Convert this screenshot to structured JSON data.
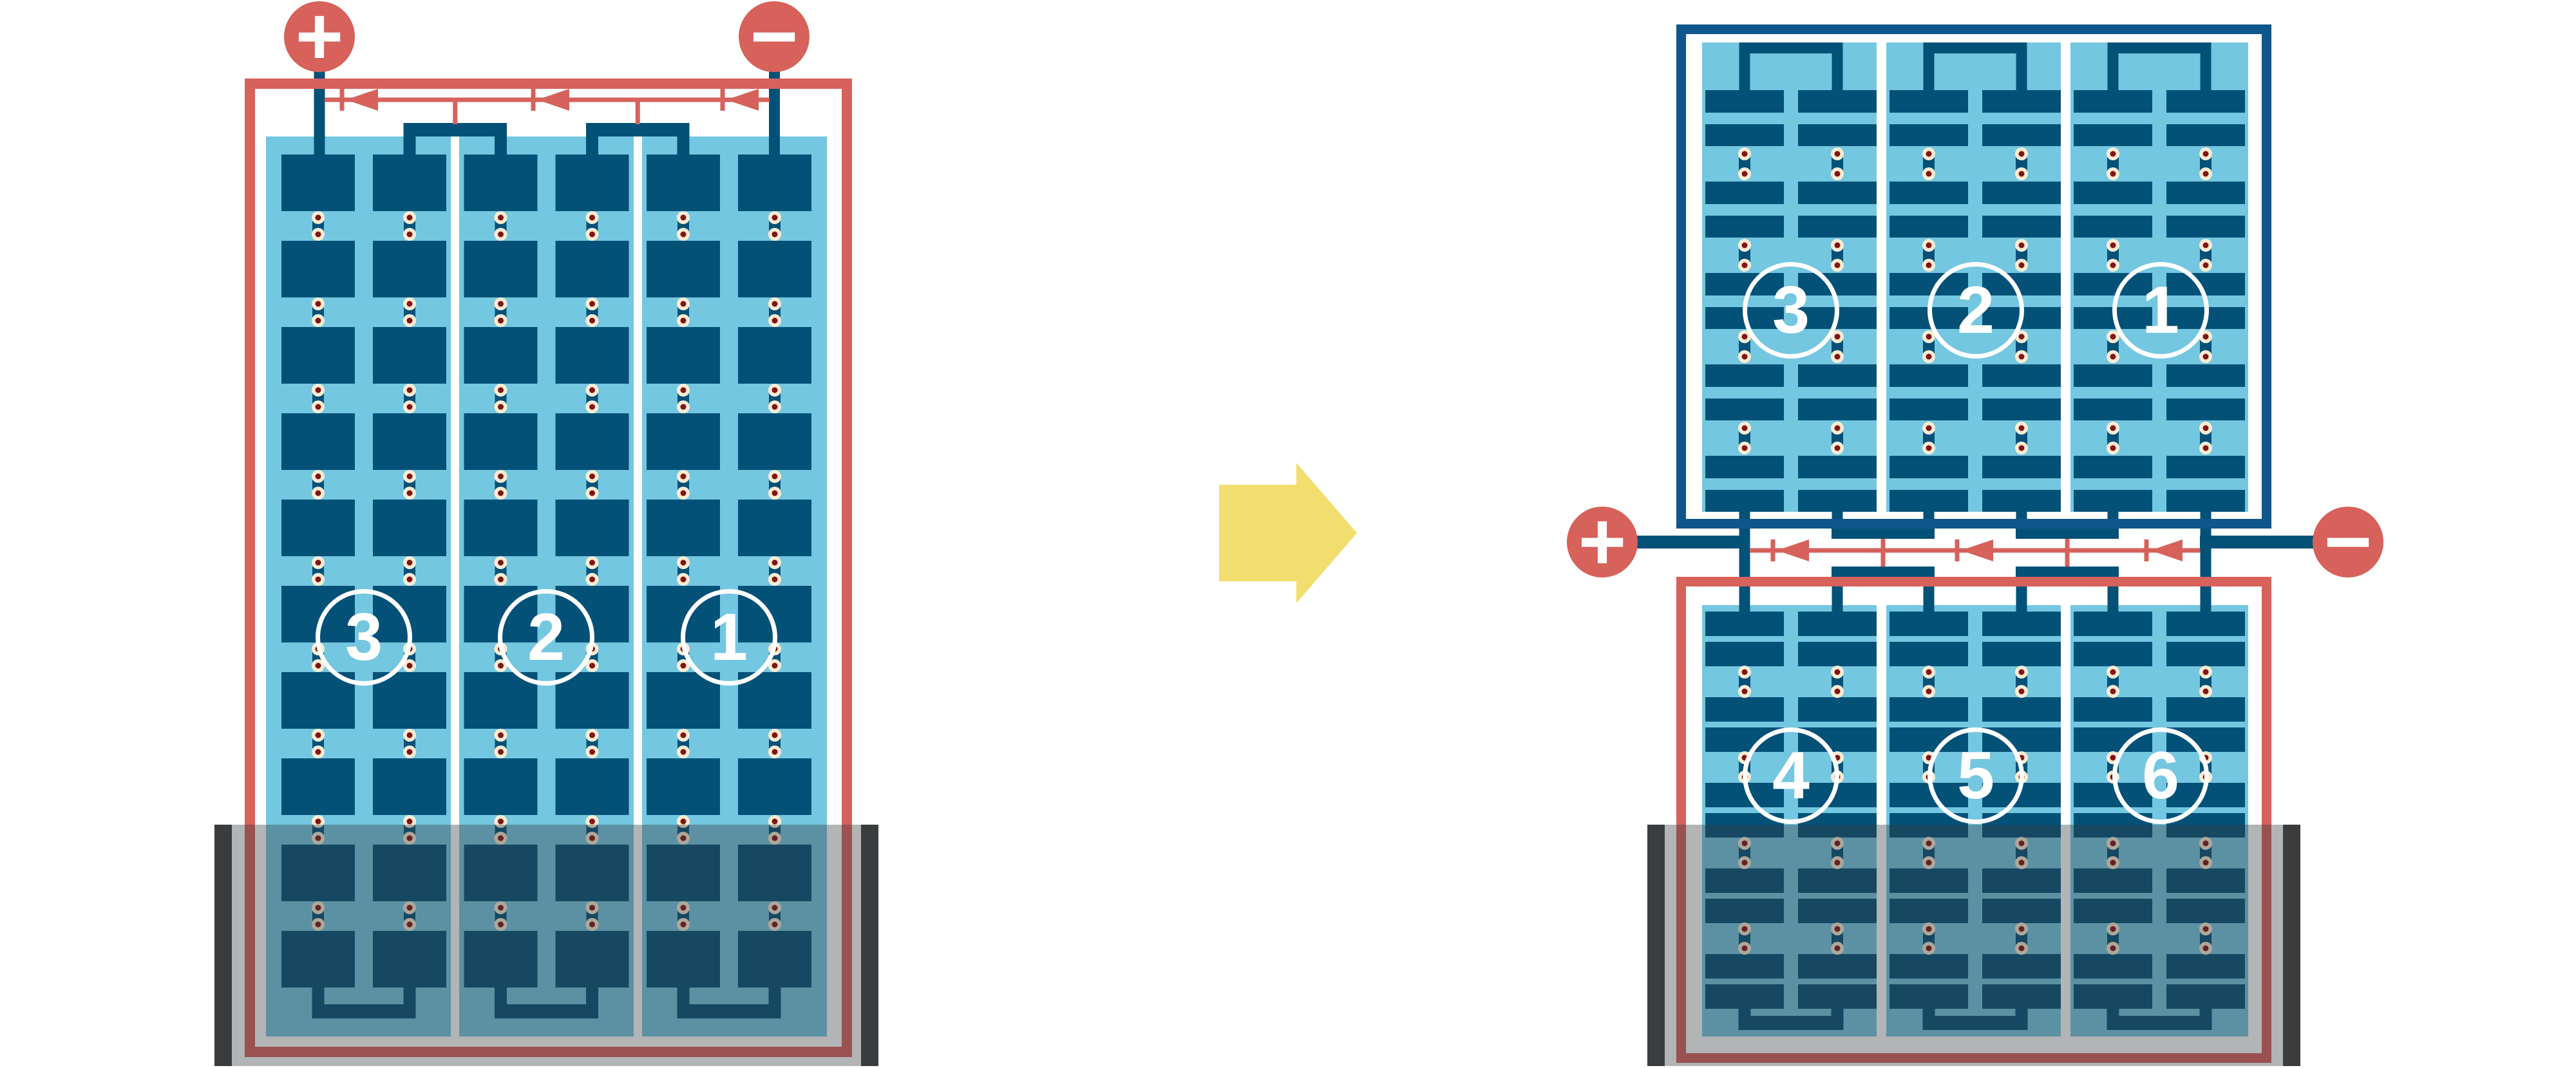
{
  "colors": {
    "red": "#D7615B",
    "cell_blue": "#045178",
    "frame_blue": "#0F568A",
    "glass_blue": "#74C7E0",
    "separator_white": "#FFFFFF",
    "solder_cream": "#F8ECD3",
    "solder_red": "#821414",
    "arrow_yellow": "#F2DE6E",
    "shade_overlay": "rgba(53,58,63,0.38)",
    "shade_end_bar": "#3B3C3E",
    "label_text": "#FFFFFF"
  },
  "left_module": {
    "terminals": {
      "positive": "+",
      "negative": "−"
    },
    "bypass_diode_count": 3,
    "strings": [
      {
        "label": "3"
      },
      {
        "label": "2"
      },
      {
        "label": "1"
      }
    ]
  },
  "transition_arrow": {
    "direction": "right"
  },
  "right_assembly": {
    "terminals": {
      "positive": "+",
      "negative": "−"
    },
    "bypass_diode_count": 3,
    "top_module": {
      "strings": [
        {
          "label": "3"
        },
        {
          "label": "2"
        },
        {
          "label": "1"
        }
      ]
    },
    "bottom_module": {
      "strings": [
        {
          "label": "4"
        },
        {
          "label": "5"
        },
        {
          "label": "6"
        }
      ]
    }
  }
}
